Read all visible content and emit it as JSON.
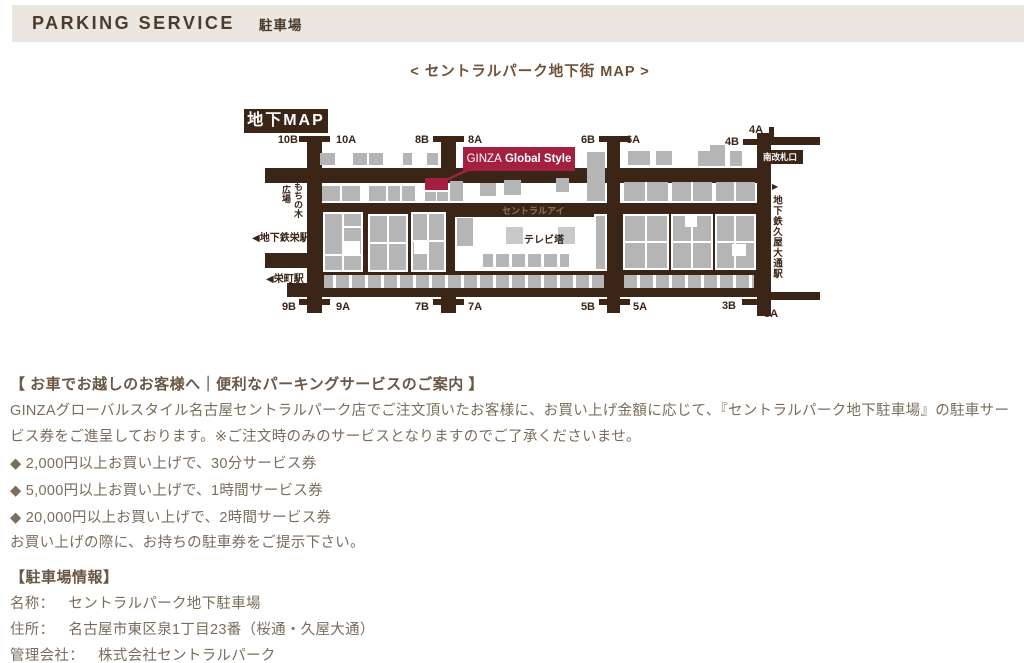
{
  "header": {
    "title": "PARKING SERVICE",
    "subtitle": "駐車場",
    "bg": "#ebe6e0",
    "text_color": "#4c3b2c"
  },
  "map": {
    "title": "< セントラルパーク地下街 MAP >",
    "badge": "地下MAP",
    "highlight_label": {
      "brand": "GINZA",
      "name": "Global Style"
    },
    "corridor_name": "セントラルアイ",
    "plaza": {
      "right_col": "もちの木",
      "left_col": "広場"
    },
    "tv_tower": "テレビ塔",
    "stations": {
      "sakae_subway": "◀地下鉄栄駅",
      "sakaemachi": "◀栄町駅",
      "south_gate": "南改札口",
      "hisaya_arrow": "▶",
      "hisaya_odori": "地下鉄久屋大通駅"
    },
    "exits_top": [
      "10B",
      "10A",
      "8B",
      "8A",
      "6B",
      "6A",
      "4B",
      "4A"
    ],
    "exits_bottom": [
      "9B",
      "9A",
      "7B",
      "7A",
      "5B",
      "5A",
      "3B",
      "3A"
    ],
    "colors": {
      "corridor": "#3a2517",
      "store": "#b5b5b5",
      "highlight": "#a32040"
    }
  },
  "service": {
    "heading": "【 お車でお越しのお客様へ｜便利なパーキングサービスのご案内 】",
    "description": "GINZAグローバルスタイル名古屋セントラルパーク店でご注文頂いたお客様に、お買い上げ金額に応じて、『セントラルパーク地下駐車場』の駐車サービス券をご進呈しております。※ご注文時のみのサービスとなりますのでご了承くださいませ。",
    "tiers": [
      "◆ 2,000円以上お買い上げで、30分サービス券",
      "◆ 5,000円以上お買い上げで、1時間サービス券",
      "◆ 20,000円以上お買い上げで、2時間サービス券"
    ],
    "note": "お買い上げの際に、お持ちの駐車券をご提示下さい。"
  },
  "parking_info": {
    "heading": "【駐車場情報】",
    "rows": [
      {
        "label": "名称：",
        "value": "セントラルパーク地下駐車場"
      },
      {
        "label": "住所：",
        "value": "名古屋市東区泉1丁目23番（桜通・久屋大通）"
      },
      {
        "label": "管理会社：",
        "value": "株式会社セントラルパーク"
      }
    ]
  }
}
